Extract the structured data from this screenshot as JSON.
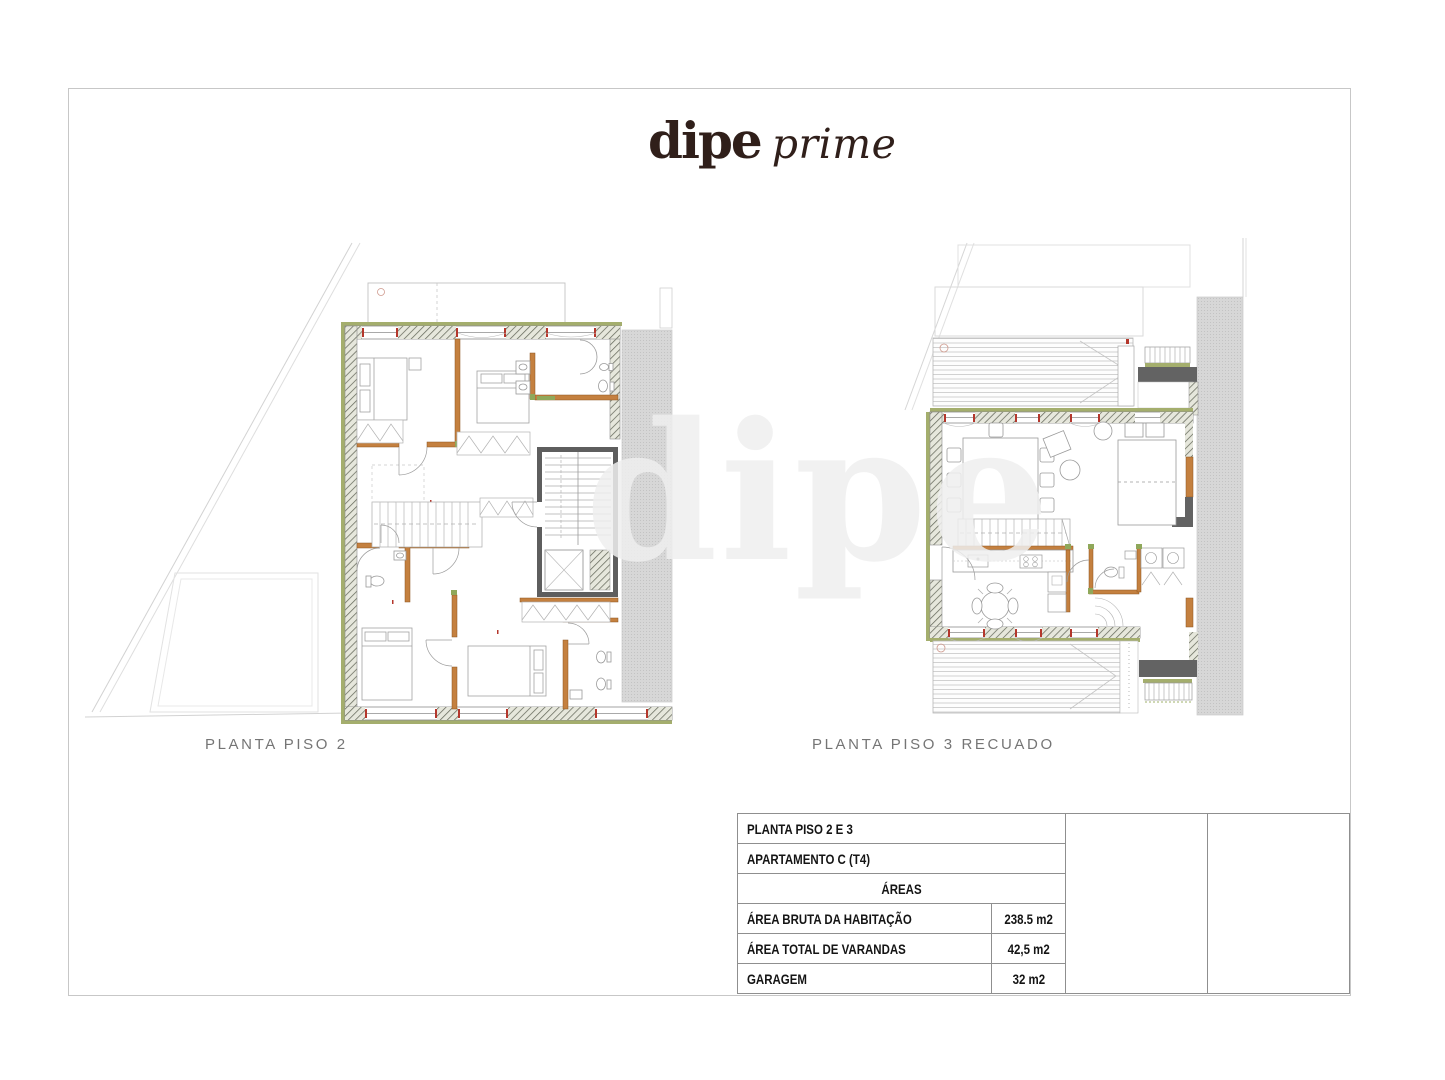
{
  "brand": {
    "name": "dipe",
    "suffix": "prime"
  },
  "plans": [
    {
      "label": "PLANTA PISO 2"
    },
    {
      "label": "PLANTA PISO 3 RECUADO"
    }
  ],
  "areas_table": {
    "title_rows": [
      "PLANTA PISO 2 E 3",
      "APARTAMENTO C (T4)"
    ],
    "section_header": "ÁREAS",
    "rows": [
      {
        "label": "ÁREA BRUTA DA HABITAÇÃO",
        "value": "238.5 m2"
      },
      {
        "label": "ÁREA TOTAL DE VARANDAS",
        "value": "42,5 m2"
      },
      {
        "label": "GARAGEM",
        "value": "32 m2"
      }
    ]
  },
  "watermark_text": "dipe",
  "colors": {
    "brand_text": "#301f1a",
    "wall_green": "#a4ae6d",
    "partition_orange": "#c4803f",
    "marker_red": "#b4372c",
    "structural_dark_gray": "#5e5e5e",
    "neighbor_gray": "#d7d7d7",
    "site_line_gray": "#d2d2d2"
  }
}
